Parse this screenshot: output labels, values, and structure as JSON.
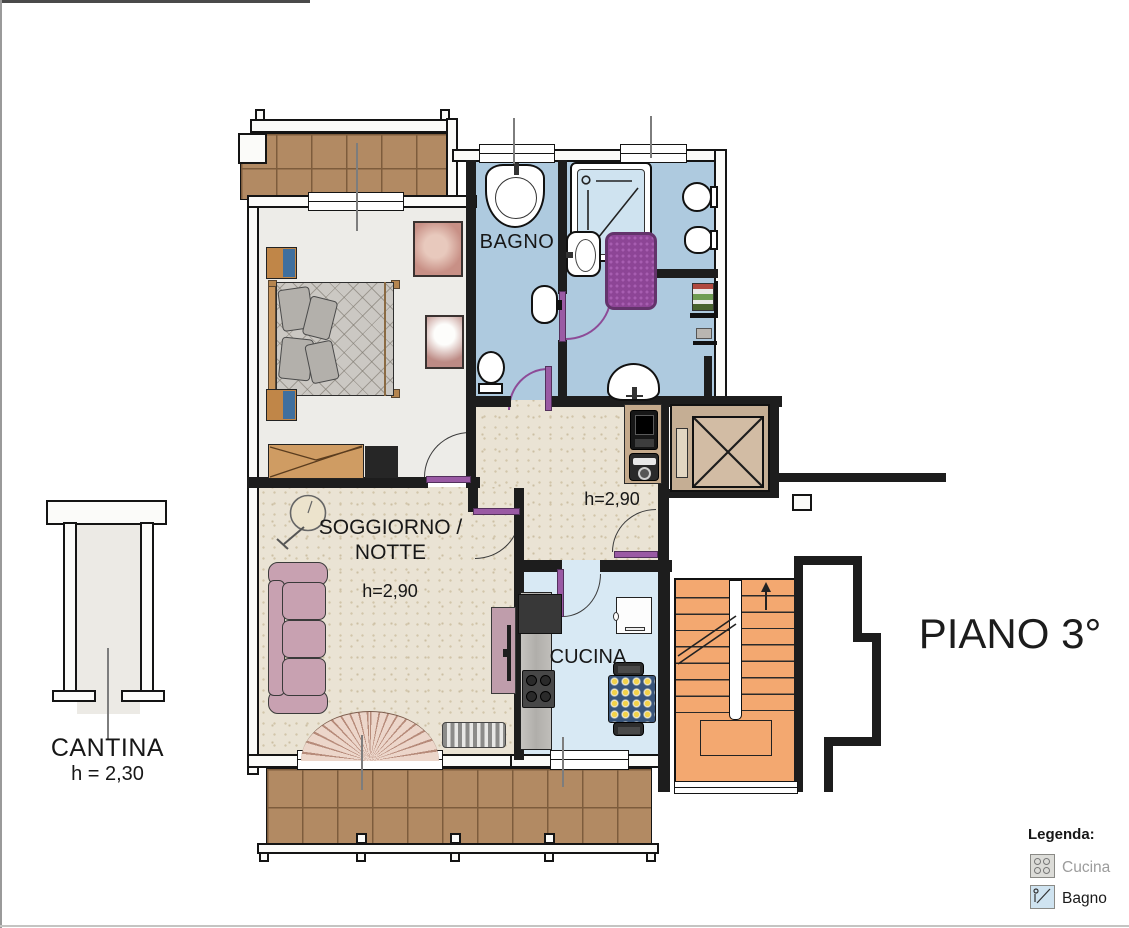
{
  "plan": {
    "floor_title": "PIANO 3°",
    "rooms": {
      "bagno1": {
        "name": "BAGNO"
      },
      "soggiorno": {
        "name_line1": "SOGGIORNO /",
        "name_line2": "NOTTE",
        "ceiling_height": "h=2,90"
      },
      "disimpegno": {
        "ceiling_height": "h=2,90"
      },
      "cucina": {
        "name": "CUCINA"
      },
      "cantina": {
        "name": "CANTINA",
        "ceiling_height": "h = 2,30"
      }
    },
    "legend": {
      "title": "Legenda:",
      "items": [
        {
          "icon": "stove-icon",
          "label": "Cucina"
        },
        {
          "icon": "shower-icon",
          "label": "Bagno"
        }
      ]
    },
    "colors": {
      "bathroom_floor": "#aecadf",
      "kitchen_floor": "#d8e9f4",
      "living_floor": "#eae3d4",
      "balcony_tile": "#b28a63",
      "stairs": "#f3a870",
      "door_accent": "#8d4b97",
      "rug": "#8d4596",
      "sofa": "#c8a1b1",
      "wall": "#1d1d1d"
    }
  }
}
